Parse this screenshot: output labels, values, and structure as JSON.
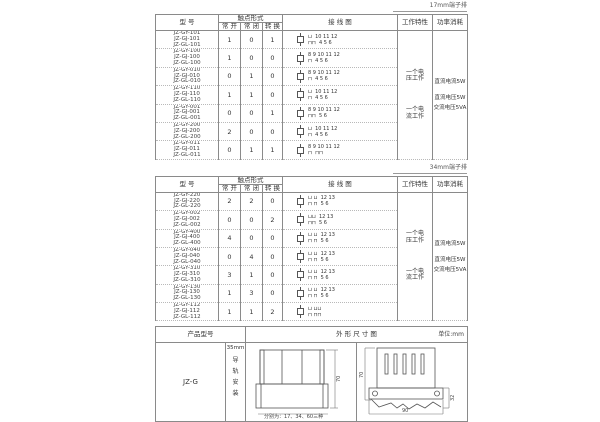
{
  "page": {
    "strip1_label": "17mm端子排",
    "strip2_label": "34mm端子排"
  },
  "headers": {
    "model": "型 号",
    "contact_form": "触点形式",
    "no": "常 开",
    "nc": "常 闭",
    "co": "转 换",
    "wiring": "接 线 图",
    "characteristic": "工作特性",
    "power": "功率消耗"
  },
  "tables": [
    {
      "rows": [
        {
          "models": "JZ-GY-101\nJZ-GJ-101\nJZ-GL-101",
          "no": "1",
          "nc": "0",
          "co": "1",
          "dt": "⊔  10 11 12",
          "db": "⊓⊓  4 5 6"
        },
        {
          "models": "JZ-GY-100\nJZ-GJ-100\nJZ-GL-100",
          "no": "1",
          "nc": "0",
          "co": "0",
          "dt": "8 9 10 11 12",
          "db": "⊓  4 5 6"
        },
        {
          "models": "JZ-GY-010\nJZ-GJ-010\nJZ-GL-010",
          "no": "0",
          "nc": "1",
          "co": "0",
          "dt": "8 9 10 11 12",
          "db": "⊓  4 5 6"
        },
        {
          "models": "JZ-GY-110\nJZ-GJ-110\nJZ-GL-110",
          "no": "1",
          "nc": "1",
          "co": "0",
          "dt": "⊔  10 11 12",
          "db": "⊓  4 5 6"
        },
        {
          "models": "JZ-GY-001\nJZ-GJ-001\nJZ-GL-001",
          "no": "0",
          "nc": "0",
          "co": "1",
          "dt": "8 9 10 11 12",
          "db": "⊓⊓  5 6"
        },
        {
          "models": "JZ-GY-200\nJZ-GJ-200\nJZ-GL-200",
          "no": "2",
          "nc": "0",
          "co": "0",
          "dt": "⊔  10 11 12",
          "db": "⊓  4 5 6"
        },
        {
          "models": "JZ-GY-011\nJZ-GJ-011\nJZ-GL-011",
          "no": "0",
          "nc": "1",
          "co": "1",
          "dt": "8 9 10 11 12",
          "db": "⊓  ⊓⊓"
        }
      ],
      "characteristic": [
        "一个电\n压工作",
        "一个电\n流工作"
      ],
      "power": [
        "直流电流5W",
        "直流电压5W",
        "交流电压5VA"
      ]
    },
    {
      "rows": [
        {
          "models": "JZ-GY-220\nJZ-GJ-220\nJZ-GL-220",
          "no": "2",
          "nc": "2",
          "co": "0",
          "dt": "⊔ ⊔  12 13",
          "db": "⊓ ⊓  5 6"
        },
        {
          "models": "JZ-GY-002\nJZ-GJ-002\nJZ-GL-002",
          "no": "0",
          "nc": "0",
          "co": "2",
          "dt": "⊔⊔  12 13",
          "db": "⊓⊓  5 6"
        },
        {
          "models": "JZ-GY-400\nJZ-GJ-400\nJZ-GL-400",
          "no": "4",
          "nc": "0",
          "co": "0",
          "dt": "⊔ ⊔  12 13",
          "db": "⊓ ⊓  5 6"
        },
        {
          "models": "JZ-GY-040\nJZ-GJ-040\nJZ-GL-040",
          "no": "0",
          "nc": "4",
          "co": "0",
          "dt": "⊔ ⊔  12 13",
          "db": "⊓ ⊓  5 6"
        },
        {
          "models": "JZ-GY-310\nJZ-GJ-310\nJZ-GL-310",
          "no": "3",
          "nc": "1",
          "co": "0",
          "dt": "⊔ ⊔  12 13",
          "db": "⊓ ⊓  5 6"
        },
        {
          "models": "JZ-GY-130\nJZ-GJ-130\nJZ-GL-130",
          "no": "1",
          "nc": "3",
          "co": "0",
          "dt": "⊔ ⊔  12 13",
          "db": "⊓ ⊓  5 6"
        },
        {
          "models": "JZ-GY-112\nJZ-GJ-112\nJZ-GL-112",
          "no": "1",
          "nc": "1",
          "co": "2",
          "dt": "⊔ ⊔⊔",
          "db": "⊓ ⊓⊓"
        }
      ],
      "characteristic": [
        "一个电\n压工作",
        "一个电\n流工作"
      ],
      "power": [
        "直流电流5W",
        "直流电压5W",
        "交流电压5VA"
      ]
    }
  ],
  "bottom": {
    "header_model": "产品型号",
    "header_outline": "外 形 尺 寸 图",
    "header_unit": "单位:mm",
    "product_model": "JZ-G",
    "rail_size": "35mm",
    "rail_vertical": "导\n轨\n安\n装",
    "front_note": "分别为：17、34、60三种",
    "dims": {
      "front_height": "70",
      "side_height": "70",
      "side_width": "90",
      "side_depth": "32"
    }
  }
}
